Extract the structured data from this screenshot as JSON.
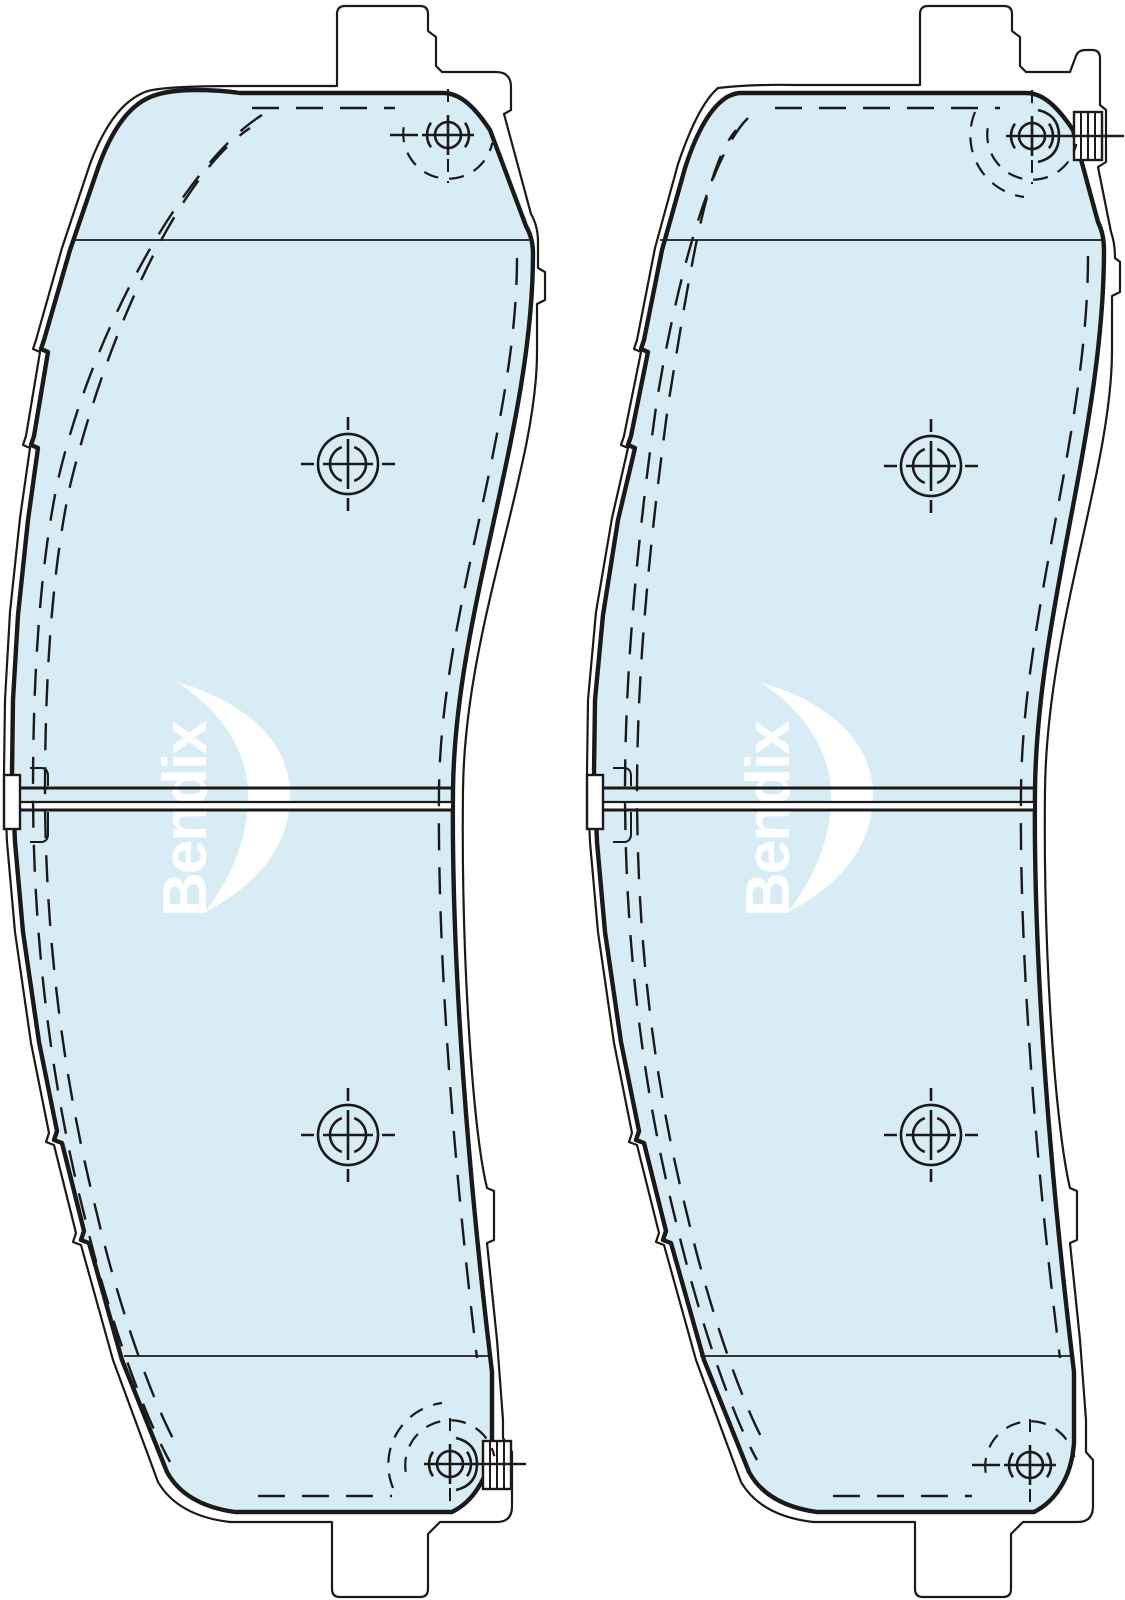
{
  "diagram": {
    "description": "Technical outline drawing of a disc brake pad set: two pad profiles side by side, each with friction surface, machining target marks, corner hole centers with dashed locating arcs, a mid-height wear slot, and a striped wear-indicator clip",
    "brand_watermark": {
      "text": "Bendix"
    },
    "colors": {
      "background": "#ffffff",
      "pad_fill": "#d7ecf5",
      "line": "#1a1a1a",
      "watermark": "#ffffff"
    },
    "slot": {
      "y_top": 788,
      "y_mid": 802,
      "y_bottom": 810
    },
    "chamfer_lines": {
      "upper_y": 240,
      "lower_y": 1356
    },
    "pads": [
      {
        "id": "pad-left",
        "wear_indicator_position": "bottom-right",
        "targets": [
          {
            "transform": "translate(348,464)"
          },
          {
            "transform": "translate(348,1135)"
          }
        ],
        "hole_top": {
          "transform": "translate(448,135)"
        },
        "hole_bottom": {
          "transform": "translate(450,1464)"
        },
        "clip_transform": "translate(483,1441)",
        "logo_transform": "translate(0,0)"
      },
      {
        "id": "pad-right",
        "wear_indicator_position": "top-right",
        "targets": [
          {
            "transform": "translate(931,466)"
          },
          {
            "transform": "translate(931,1135)"
          }
        ],
        "hole_top": {
          "transform": "translate(1032,136)"
        },
        "hole_bottom": {
          "transform": "translate(1030,1465)"
        },
        "clip_transform": "translate(1074,112)",
        "logo_transform": "translate(583,0)"
      }
    ]
  }
}
